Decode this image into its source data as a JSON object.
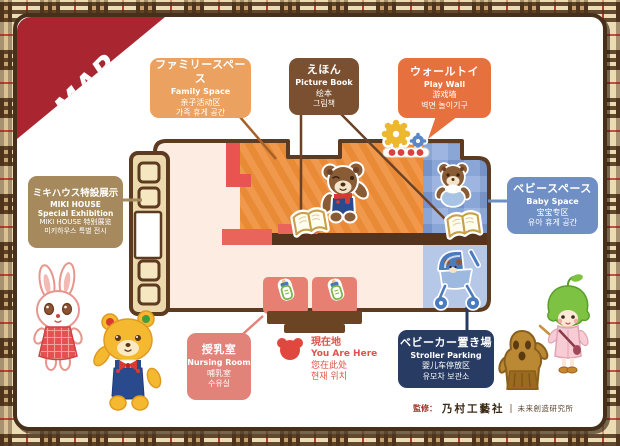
{
  "ribbon": {
    "label": "MAP"
  },
  "areas": {
    "family_space": {
      "ja": "ファミリースペース",
      "en": "Family Space",
      "zh": "亲子活动区",
      "ko": "가족 휴게 공간"
    },
    "picture_book": {
      "ja": "えほん",
      "en": "Picture Book",
      "zh": "绘本",
      "ko": "그림책"
    },
    "play_wall": {
      "ja": "ウォールトイ",
      "en": "Play Wall",
      "zh": "游戏墙",
      "ko": "벽면 놀이기구"
    },
    "miki_exhibition": {
      "ja": "ミキハウス特設展示",
      "en_line1": "MIKI HOUSE",
      "en_line2": "Special Exhibition",
      "zh": "MIKI HOUSE 特别展览",
      "ko": "미키하우스 특별 전시"
    },
    "baby_space": {
      "ja": "ベビースペース",
      "en": "Baby Space",
      "zh": "宝宝专区",
      "ko": "유아 휴게 공간"
    },
    "nursing_room": {
      "ja": "授乳室",
      "en": "Nursing Room",
      "zh": "哺乳室",
      "ko": "수유실"
    },
    "you_are_here": {
      "ja": "現在地",
      "en": "You Are Here",
      "zh": "您在此处",
      "ko": "현재 위치"
    },
    "stroller_parking": {
      "ja": "ベビーカー置き場",
      "en": "Stroller Parking",
      "zh": "婴儿车停放区",
      "ko": "유모차 보관소"
    }
  },
  "credit": {
    "prefix": "監修：",
    "company": "乃村工藝社",
    "separator": "|",
    "institute": "未来創造研究所"
  },
  "colors": {
    "ribbon_red": "#a92630",
    "frame_brown": "#46301a",
    "family_box": "#eba15f",
    "picture_book_box": "#7b5030",
    "play_wall_box": "#e7703f",
    "miki_box": "#a68a5e",
    "baby_box": "#7090c5",
    "nursing_box": "#e2837a",
    "stroller_box": "#283c63",
    "you_are_here_red": "#e0524a",
    "floor": "#fcece1",
    "family_mat_orange": "#f0994c",
    "baby_check_blue": "#7593c9",
    "stroller_zone_blue": "#b5c8e8"
  }
}
